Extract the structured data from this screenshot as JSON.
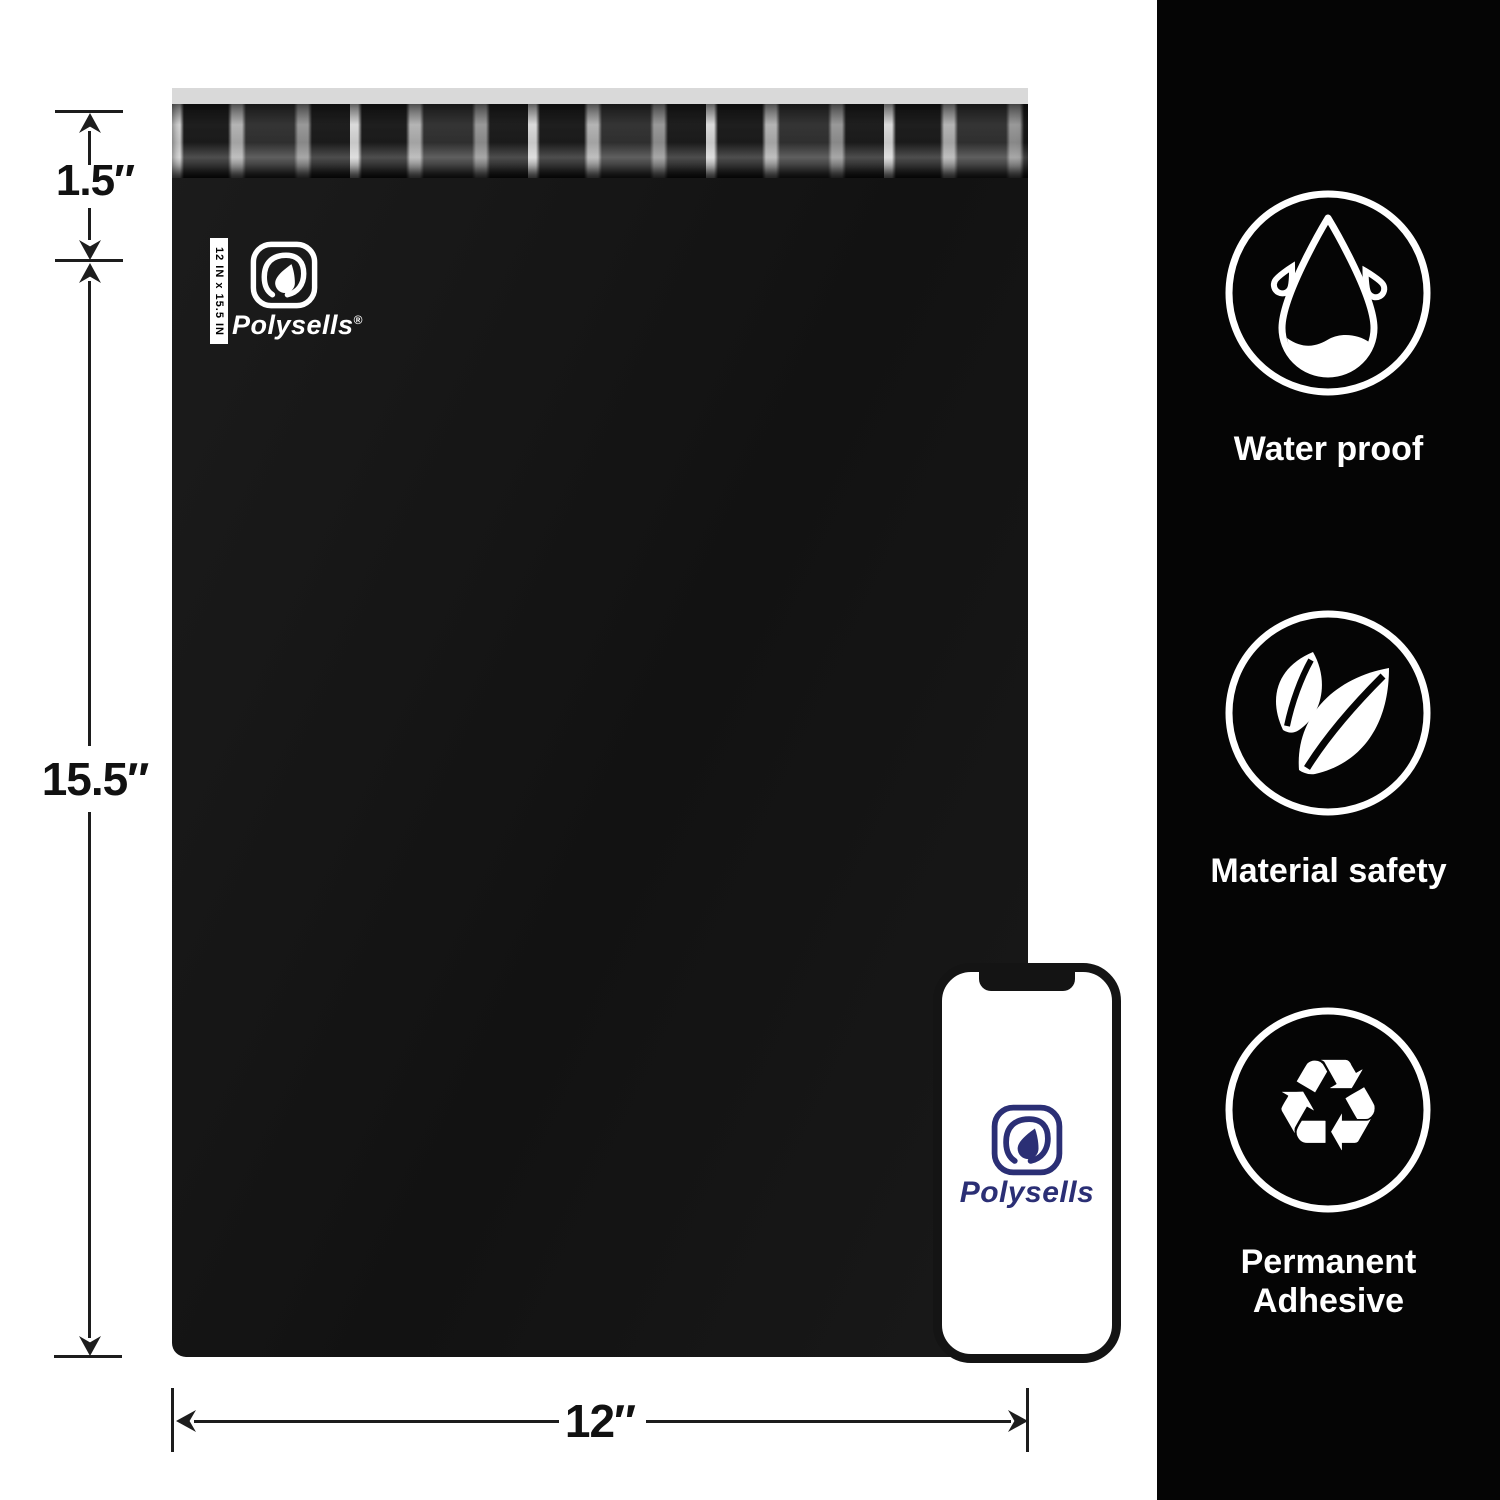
{
  "bag": {
    "size_tag": "12 IN x 15.5 IN",
    "brand": "Polysells",
    "registered_mark": "®"
  },
  "measurements": {
    "flap_height": "1.5″",
    "bag_height": "15.5″",
    "bag_width": "12″"
  },
  "phone": {
    "brand": "Polysells"
  },
  "features": [
    {
      "icon": "water-drop-icon",
      "label": "Water proof"
    },
    {
      "icon": "leaf-icon",
      "label": "Material safety"
    },
    {
      "icon": "recycle-icon",
      "label": "Permanent Adhesive",
      "glyph": "♻"
    }
  ],
  "colors": {
    "bag": "#161616",
    "sidebar": "#050505",
    "liner_strip": "#d9d9d9",
    "brand_navy": "#2b2f75",
    "annotation": "#1d1d1d",
    "feature_icon": "#ffffff"
  }
}
